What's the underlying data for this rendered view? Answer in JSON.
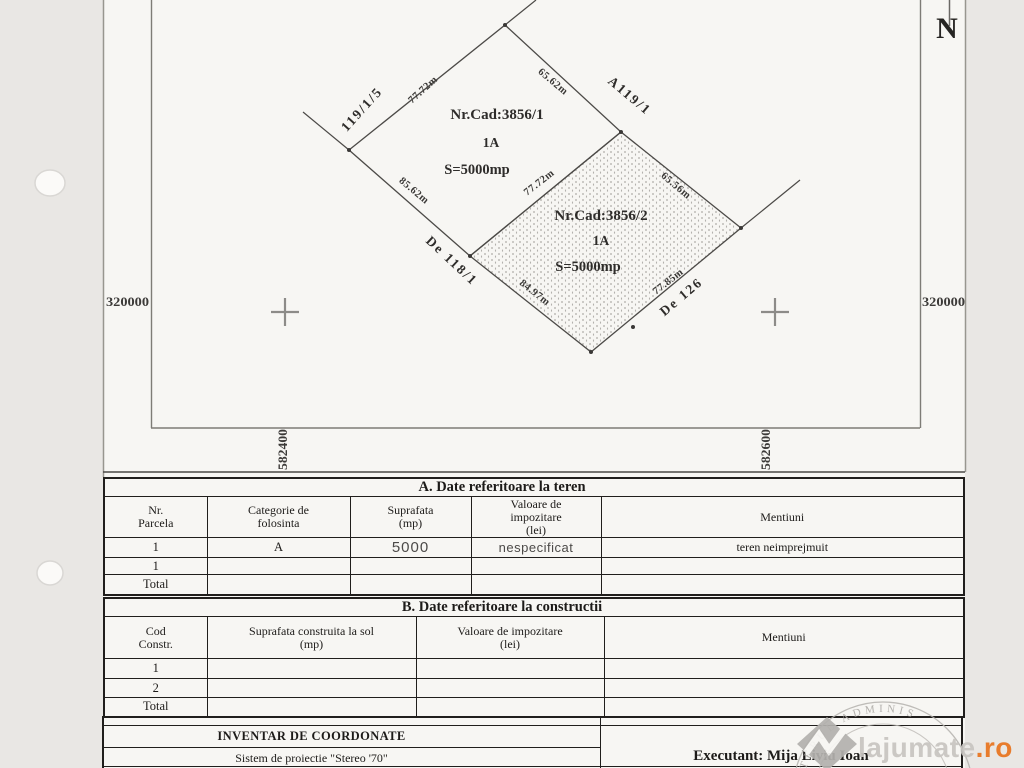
{
  "page": {
    "north": "N",
    "coords": {
      "left": "320000",
      "right": "320000",
      "bottom_left": "582400",
      "bottom_right": "582600"
    }
  },
  "plan": {
    "parcels": [
      {
        "nr_cad": "Nr.Cad:3856/1",
        "code": "1A",
        "area": "S=5000mp",
        "dims": {
          "top_left": "77.72m",
          "top_right": "65.62m",
          "bottom_left": "85.62m",
          "bottom_right": "77.72m"
        }
      },
      {
        "nr_cad": "Nr.Cad:3856/2",
        "code": "1A",
        "area": "S=5000mp",
        "dims": {
          "top_left": "77.72m",
          "top_right": "65.56m",
          "bottom_left": "84.97m",
          "bottom_right": "77.85m"
        }
      }
    ],
    "neighbors": {
      "north_west": "119/1/5",
      "north_east": "A119/1",
      "south_west": "De 118/1",
      "south_east": "De 126"
    }
  },
  "tables": {
    "a": {
      "title": "A. Date referitoare la teren",
      "headers": [
        "Nr.\nParcela",
        "Categorie de\nfolosinta",
        "Suprafata\n(mp)",
        "Valoare de\nimpozitare\n(lei)",
        "Mentiuni"
      ],
      "rows": [
        [
          "1",
          "A",
          "5000",
          "nespecificat",
          "teren neimprejmuit"
        ],
        [
          "1",
          "",
          "",
          "",
          ""
        ],
        [
          "Total",
          "",
          "",
          "",
          ""
        ]
      ]
    },
    "b": {
      "title": "B. Date referitoare la constructii",
      "headers": [
        "Cod\nConstr.",
        "Suprafata construita la sol\n(mp)",
        "Valoare de impozitare\n(lei)",
        "Mentiuni"
      ],
      "rows": [
        [
          "1",
          "",
          "",
          ""
        ],
        [
          "2",
          "",
          "",
          ""
        ],
        [
          "Total",
          "",
          "",
          ""
        ]
      ]
    }
  },
  "footer": {
    "inventar_title": "INVENTAR DE COORDONATE",
    "projection": "Sistem de proiectie \"Stereo '70\"",
    "executant": "Executant: Mija Liviu Ioan"
  },
  "watermark": {
    "stamp_arc_text": "STERUL  ADMINIS",
    "brand": "lajumate",
    "brand_tld": ".ro",
    "accent_orange": "#e8731d"
  }
}
